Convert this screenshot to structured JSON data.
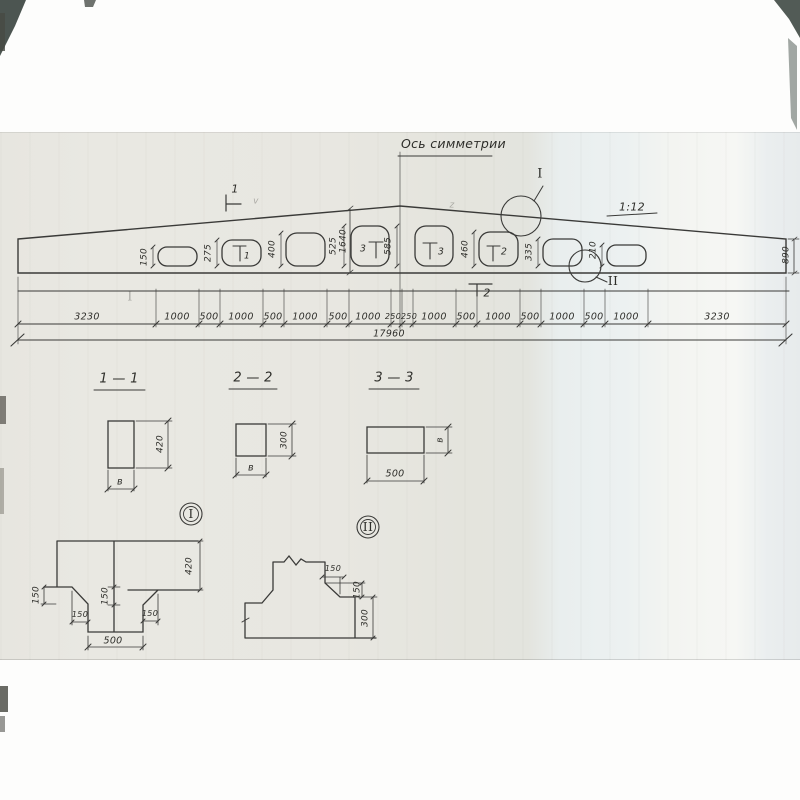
{
  "drawing": {
    "title": "Ось симметрии",
    "slope": "1:12",
    "end_height": "890",
    "mid_height": "1640",
    "mid_opening": "585",
    "opening_heights": [
      "150",
      "275",
      "400",
      "525",
      "460",
      "335",
      "210"
    ],
    "flags": {
      "top": "1",
      "bottom": "2",
      "o2": "1",
      "o4": "3",
      "o5": "3",
      "o6": "2"
    },
    "marker_i": "I",
    "marker_ii": "II",
    "chain": [
      "3230",
      "1000",
      "500",
      "1000",
      "500",
      "1000",
      "500",
      "1000",
      "250",
      "250",
      "1000",
      "500",
      "1000",
      "500",
      "1000",
      "500",
      "1000",
      "3230"
    ],
    "total": "17960"
  },
  "sections": {
    "s11": {
      "title": "1 — 1",
      "h": "420",
      "w": "в"
    },
    "s22": {
      "title": "2 — 2",
      "h": "300",
      "w": "в"
    },
    "s33": {
      "title": "3 — 3",
      "w": "500",
      "h": "в"
    }
  },
  "details": {
    "i": {
      "label": "I",
      "d150a": "150",
      "d150b": "150",
      "d150c": "150",
      "d150d": "150",
      "w500": "500",
      "h420": "420"
    },
    "ii": {
      "label": "II",
      "d150a": "150",
      "d150b": "150",
      "h300": "300"
    }
  },
  "artifacts": {
    "check1": "v",
    "check2": "z",
    "ghost": "I"
  }
}
